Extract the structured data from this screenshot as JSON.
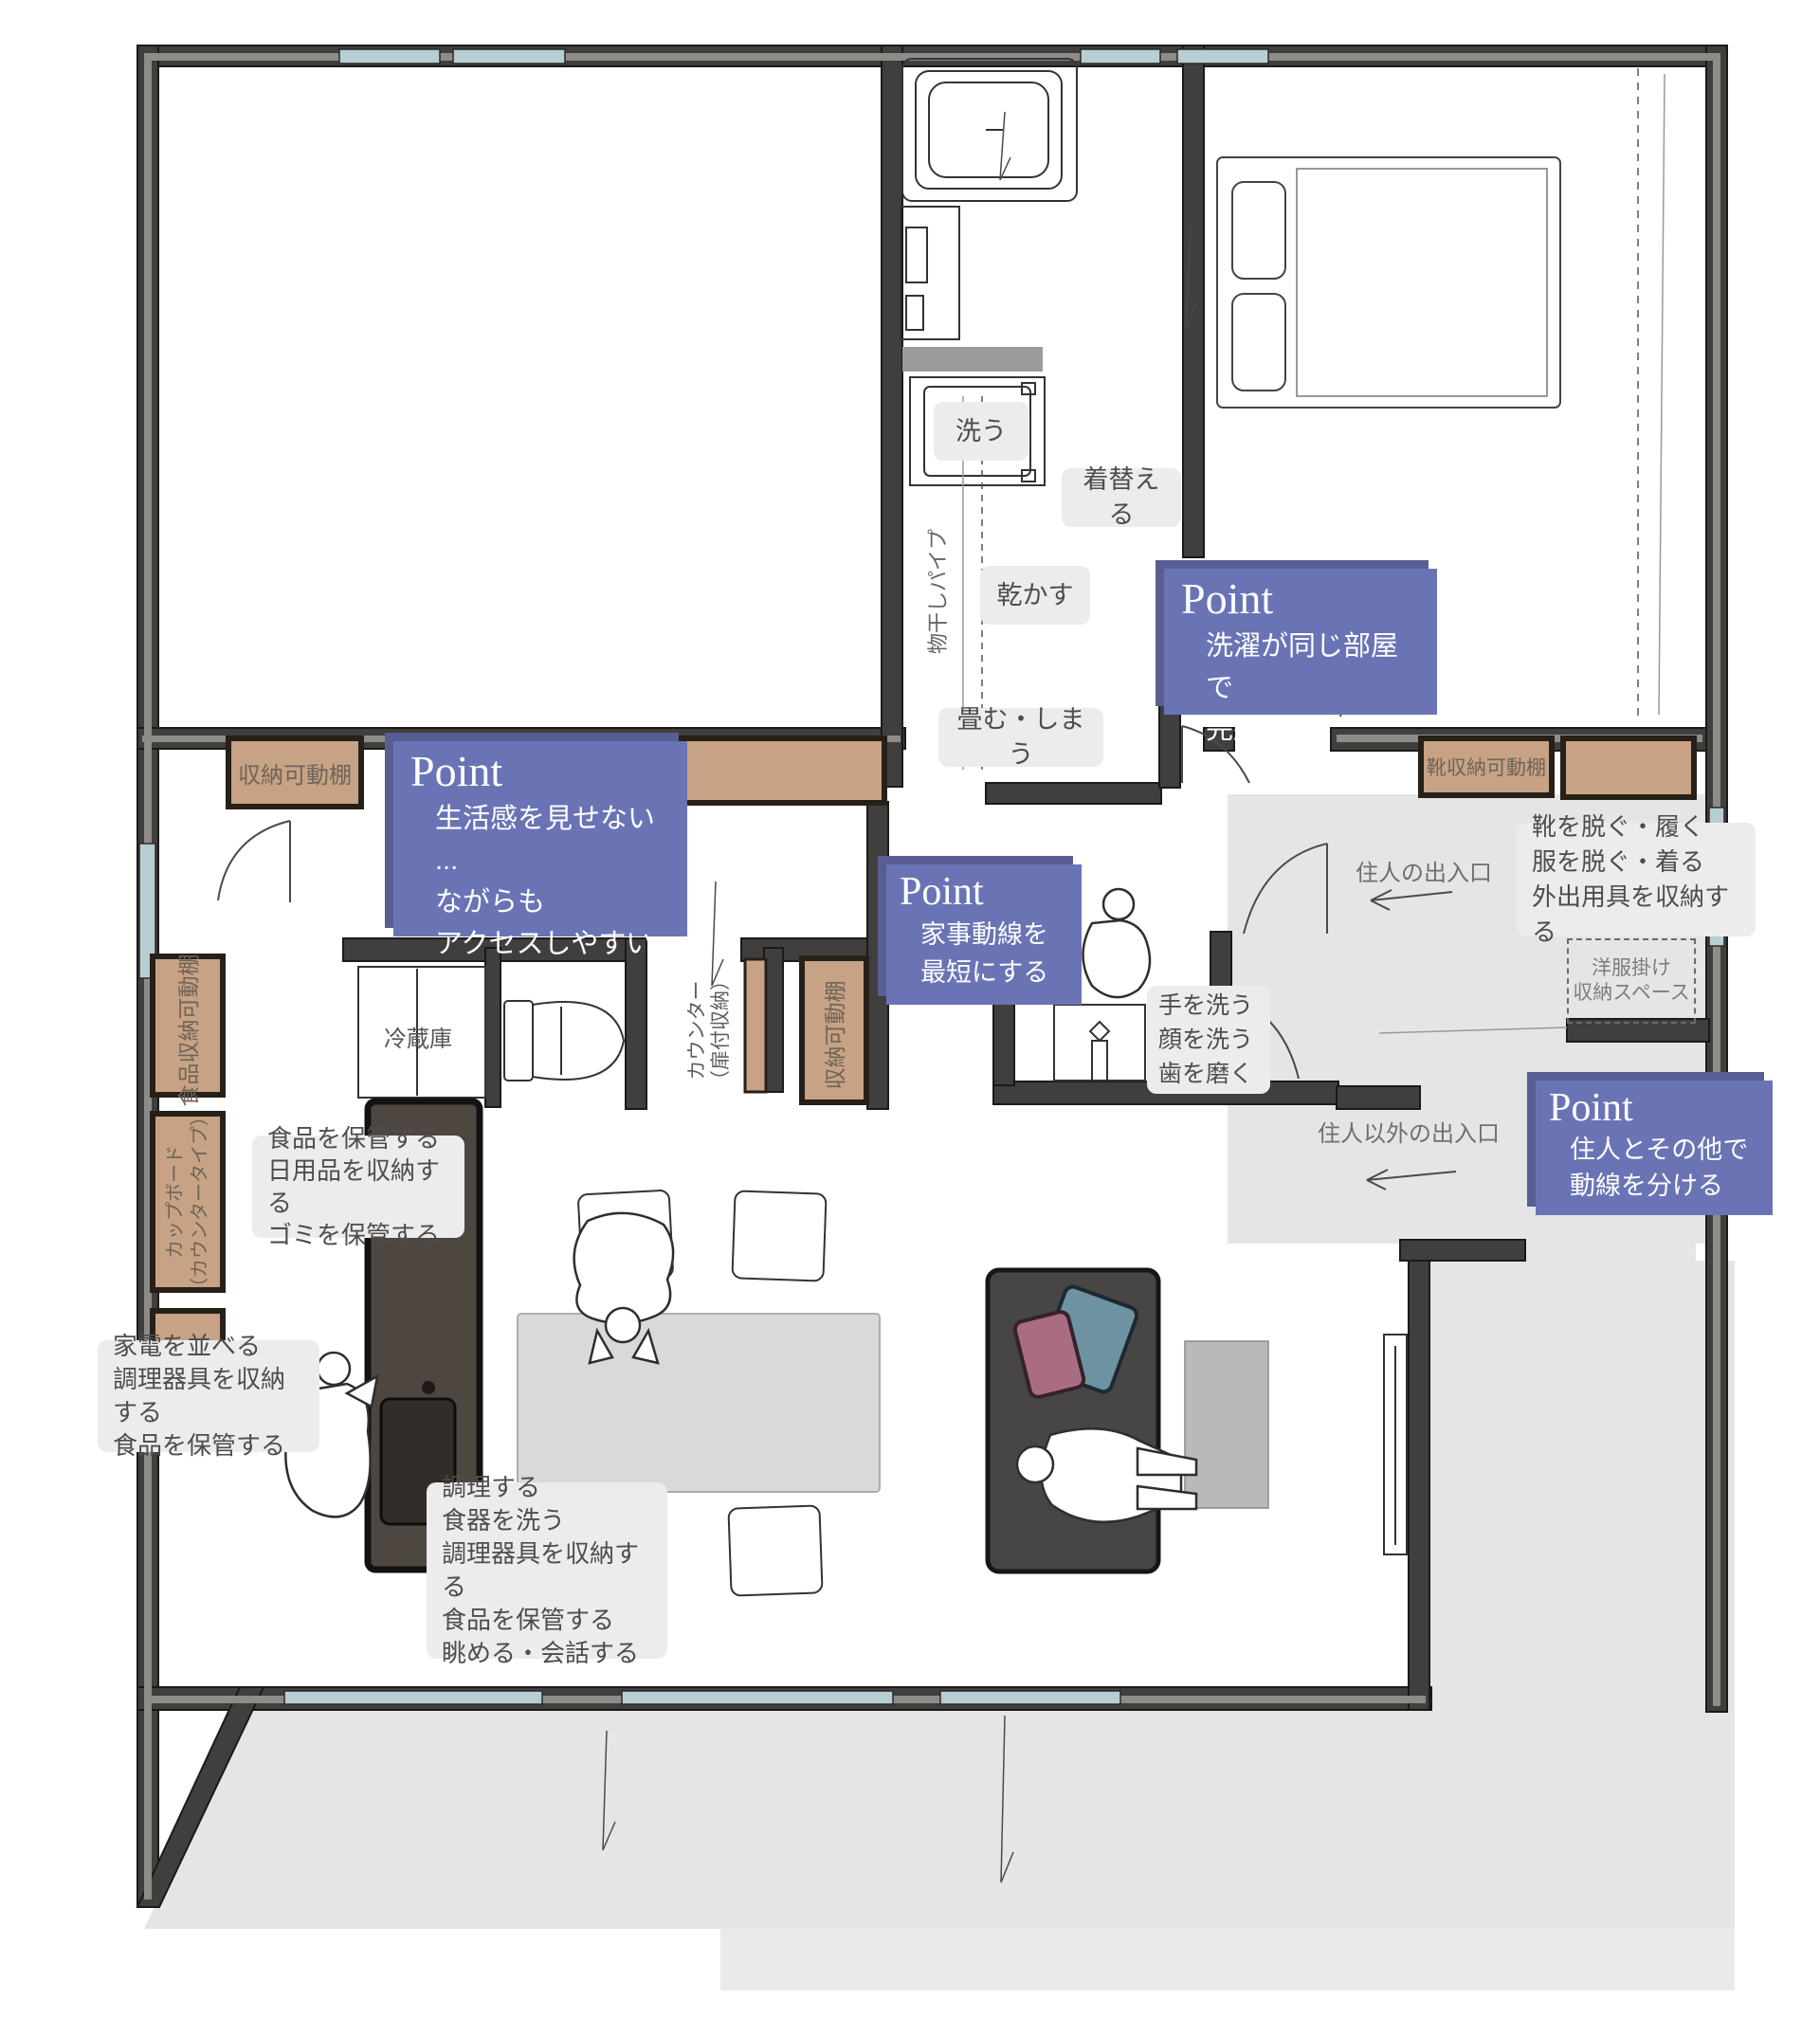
{
  "plan": {
    "points": [
      {
        "title": "Point",
        "line1": "生活感を見せない ...",
        "line2": "ながらも",
        "line3": "アクセスしやすい"
      },
      {
        "title": "Point",
        "line1": "洗濯が同じ部屋で",
        "line2": "完結する"
      },
      {
        "title": "Point",
        "line1": "家事動線を",
        "line2": "最短にする"
      },
      {
        "title": "Point",
        "line1": "住人とその他で",
        "line2": "動線を分ける"
      }
    ],
    "activities": {
      "wash": "洗う",
      "change": "着替える",
      "dry": "乾かす",
      "fold": "畳む・しまう",
      "entry": {
        "l1": "靴を脱ぐ・履く",
        "l2": "服を脱ぐ・着る",
        "l3": "外出用具を収納する"
      },
      "sink": {
        "l1": "手を洗う",
        "l2": "顔を洗う",
        "l3": "歯を磨く"
      },
      "pantry": {
        "l1": "食品を保管する",
        "l2": "日用品を収納する",
        "l3": "ゴミを保管する"
      },
      "cupboard": {
        "l1": "家電を並べる",
        "l2": "調理器具を収納する",
        "l3": "食品を保管する"
      },
      "kitchen": {
        "l1": "調理する",
        "l2": "食器を洗う",
        "l3": "調理器具を収納する",
        "l4": "食品を保管する",
        "l5": "眺める・会話する"
      }
    },
    "fixtures": {
      "shelf_top": "収納可動棚",
      "shoe_shelf": "靴収納可動棚",
      "food_shelf": "食品収納可動棚",
      "cupboard_l1": "カップボード",
      "cupboard_l2": "（カウンタータイプ）",
      "counter_l1": "カウンター",
      "counter_l2": "（扉付収納）",
      "serve_shelf": "収納可動棚",
      "fridge": "冷蔵庫",
      "laundry_pipe": "物干しパイプ",
      "wardrobe_l1": "洋服掛け",
      "wardrobe_l2": "収納スペース"
    },
    "flows": {
      "resident": "住人の出入口",
      "visitor": "住人以外の出入口"
    },
    "colors": {
      "point_bg": "#6a74b5",
      "point_shadow": "#585e91",
      "wall": "#413f3d",
      "window": "#b7ced3",
      "shelf": "#c7a284",
      "floor_gray": "#e5e5e5",
      "label_bg": "#ececec"
    }
  }
}
